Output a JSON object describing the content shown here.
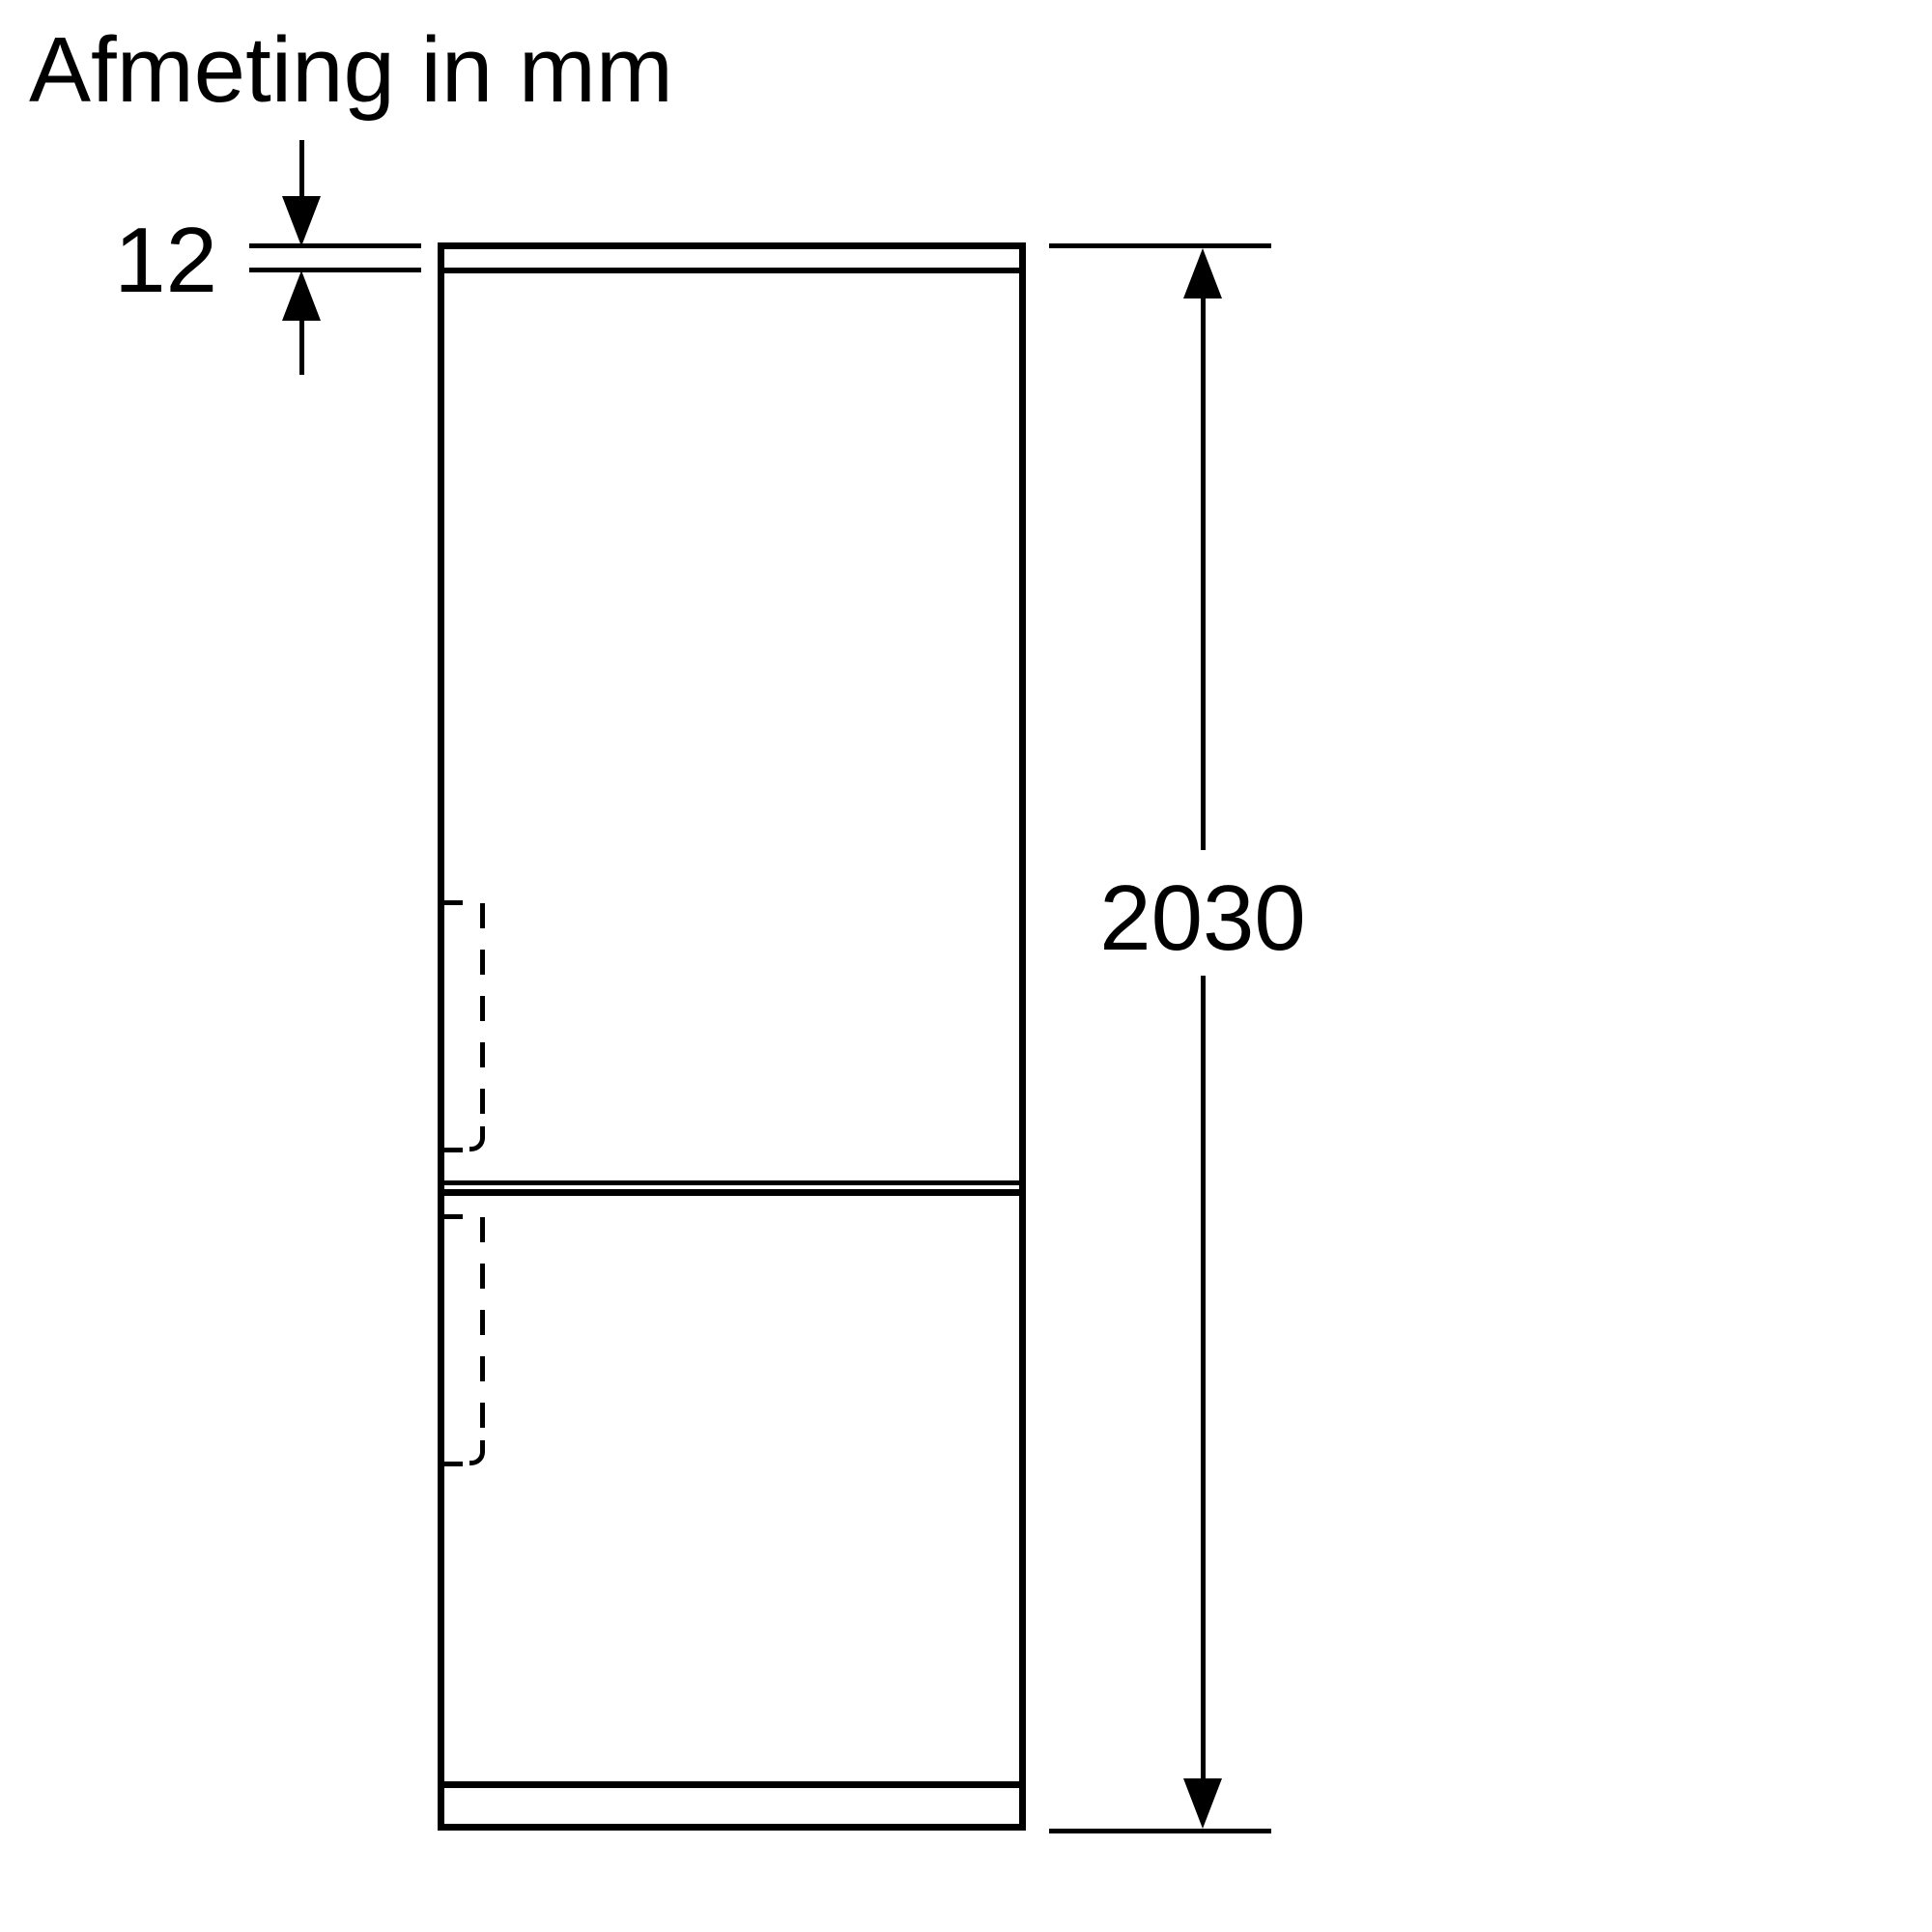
{
  "title": "Afmeting in mm",
  "drawing": {
    "subject": "refrigerator-front-outline",
    "line_color": "#000000",
    "background_color": "#ffffff",
    "unit": "mm",
    "dimensions": {
      "top_thickness": {
        "value": "12"
      },
      "total_height": {
        "value": "2030"
      }
    }
  }
}
